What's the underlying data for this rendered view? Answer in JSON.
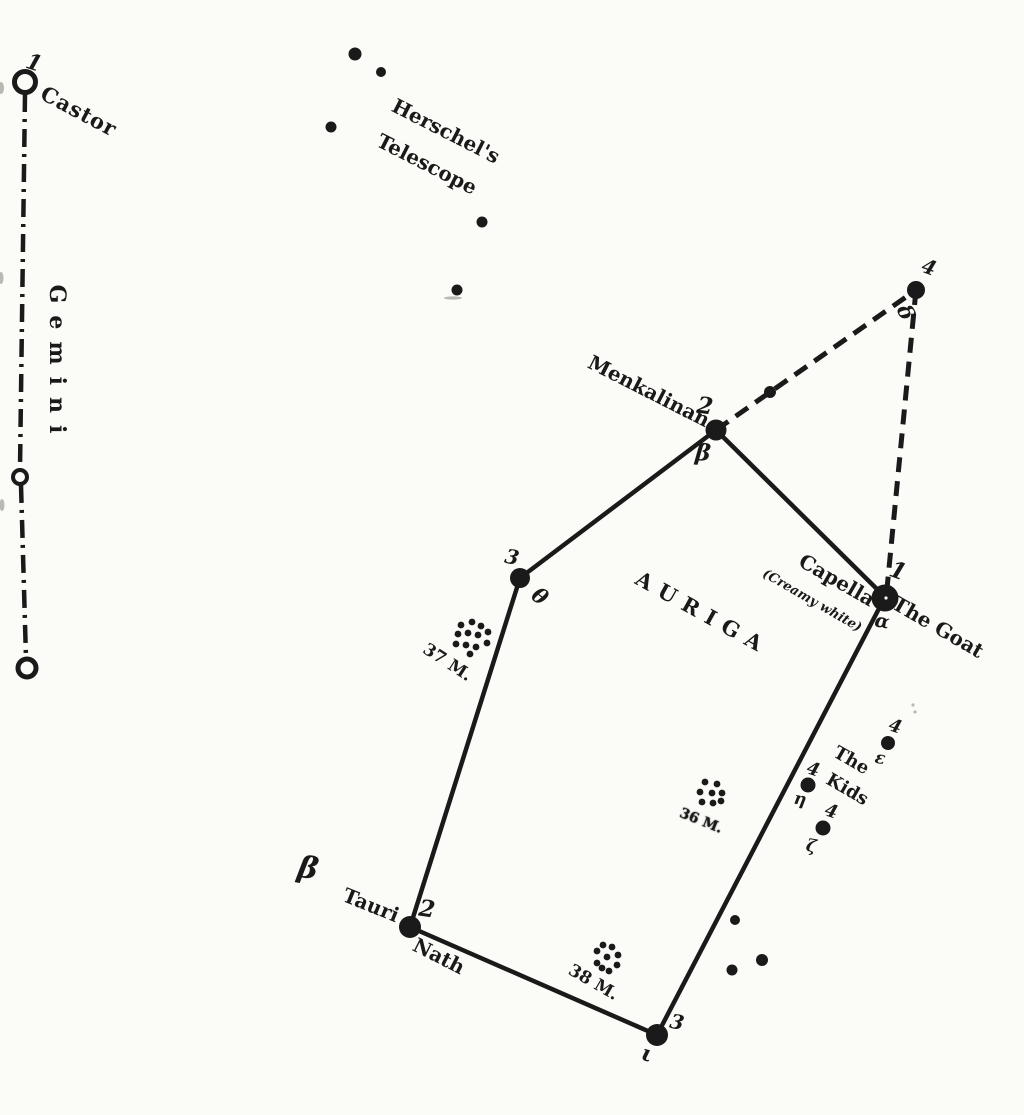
{
  "page": {
    "ink": "#1a1a1a",
    "paper": "#fbfbf8"
  },
  "gemini": {
    "constellation_label": "Gemini",
    "castor": {
      "magnitude": "1",
      "name": "Castor"
    }
  },
  "herschels_telescope": {
    "line1": "Herschel's",
    "line2": "Telescope"
  },
  "auriga": {
    "constellation_label": "AURIGA",
    "stars": {
      "menkalinan": {
        "magnitude": "2",
        "name": "Menkalinan",
        "bayer": "β"
      },
      "delta": {
        "magnitude": "4",
        "bayer": "δ"
      },
      "capella": {
        "magnitude": "1",
        "name": "Capella",
        "color_note": "(Creamy white)",
        "alt_name": "The Goat",
        "bayer": "α"
      },
      "theta": {
        "magnitude": "3",
        "bayer": "θ"
      },
      "nath": {
        "magnitude": "2",
        "name": "Nath",
        "bayer": "β",
        "flamsteed_label": "Tauri"
      },
      "iota": {
        "magnitude": "3",
        "bayer": "ι"
      },
      "epsilon": {
        "magnitude": "4",
        "bayer": "ε"
      },
      "eta": {
        "magnitude": "4",
        "bayer": "η"
      },
      "zeta": {
        "magnitude": "4",
        "bayer": "ζ"
      }
    },
    "kids": {
      "line1": "The",
      "line2": "Kids"
    },
    "clusters": {
      "m37": "37 M.",
      "m36": "36 M.",
      "m38": "38 M."
    }
  }
}
